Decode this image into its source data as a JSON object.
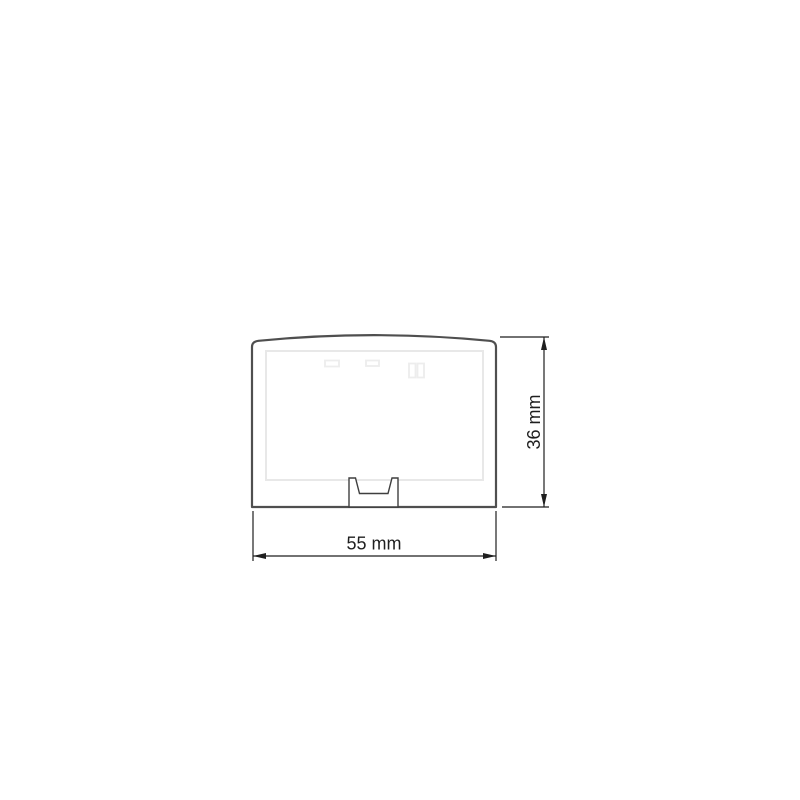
{
  "page": {
    "background_color": "#ffffff"
  },
  "drawing": {
    "unit": "mm",
    "dimensions": {
      "width": {
        "value": 55,
        "label": "55 mm"
      },
      "height": {
        "value": 36,
        "label": "36 mm"
      }
    },
    "colors": {
      "outline": "#4f4f4f",
      "panel_line": "#e8e8e8",
      "slot_line": "#ededed",
      "clip_line": "#3f3f3f",
      "dimension": "#1f1f1f",
      "background": "#ffffff"
    }
  }
}
